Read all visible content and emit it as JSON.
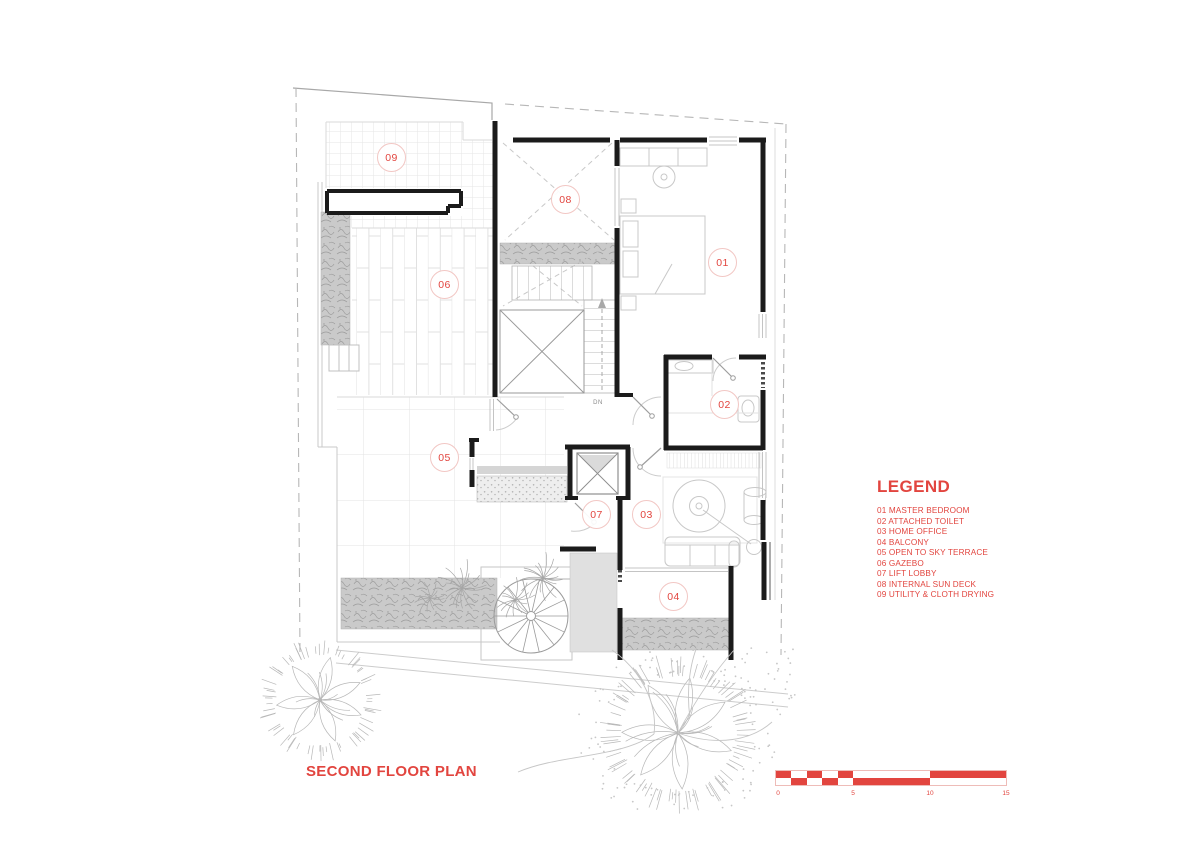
{
  "title": "SECOND FLOOR PLAN",
  "legend": {
    "heading": "LEGEND",
    "items": [
      "01 MASTER BEDROOM",
      "02 ATTACHED TOILET",
      "03 HOME OFFICE",
      "04 BALCONY",
      "05 OPEN TO SKY TERRACE",
      "06 GAZEBO",
      "07 LIFT LOBBY",
      "08 INTERNAL SUN DECK",
      "09 UTILITY & CLOTH DRYING"
    ]
  },
  "rooms": [
    {
      "number": "01",
      "name": "MASTER BEDROOM"
    },
    {
      "number": "02",
      "name": "ATTACHED TOILET"
    },
    {
      "number": "03",
      "name": "HOME OFFICE"
    },
    {
      "number": "04",
      "name": "BALCONY"
    },
    {
      "number": "05",
      "name": "OPEN TO SKY TERRACE"
    },
    {
      "number": "06",
      "name": "GAZEBO"
    },
    {
      "number": "07",
      "name": "LIFT LOBBY"
    },
    {
      "number": "08",
      "name": "INTERNAL SUN DECK"
    },
    {
      "number": "09",
      "name": "UTILITY & CLOTH DRYING"
    }
  ],
  "stairs": {
    "down_label": "DN"
  },
  "scalebar": {
    "labels": [
      "0",
      "5",
      "10",
      "15"
    ]
  },
  "colors": {
    "accent": "#e2453f",
    "wall": "#1b1b1b"
  }
}
